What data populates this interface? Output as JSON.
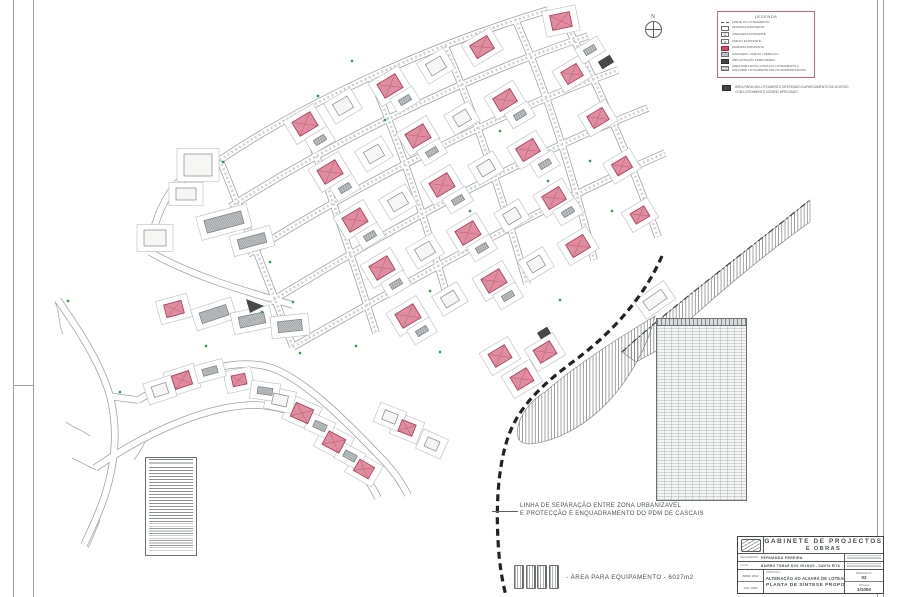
{
  "north": {
    "label": "N"
  },
  "legend": {
    "title": "LEGENDA",
    "items": [
      {
        "symbol": "limit-line",
        "label": "LIMITE DO LOTEAMENTO"
      },
      {
        "symbol": "existing-house",
        "label": "MORADIA EXISTENTE",
        "glyph": ""
      },
      {
        "symbol": "existing-garage",
        "label": "GARAGEM EXISTENTE",
        "glyph": "G"
      },
      {
        "symbol": "existing-annex",
        "label": "ANEXO EXISTENTE",
        "glyph": "A"
      },
      {
        "symbol": "proposed-house",
        "label": "MORADIA PROPOSTA"
      },
      {
        "symbol": "garage-annex-pergola",
        "label": "GARAGEM / ANEXO / PÉRGULA"
      },
      {
        "symbol": "temporary-implantation",
        "label": "IMPLANTAÇÃO TEMPORÁRIA"
      },
      {
        "symbol": "two-lots-area",
        "label": "ÁREA PARA DOIS LOTES DO LOTEAMENTO A ADQUIRIR TOTALMENTE PELOS PROPRIETÁRIOS"
      }
    ]
  },
  "legend_note": {
    "line1": "ÁREA PARA UM LOTEAMENTO DESTINADO A APARCAMENTO DE ACORDO",
    "line2": "COM LOTEAMENTO VIZINHO APROVADO"
  },
  "annotations": {
    "separation_line_1": "LINHA DE SEPARAÇÃO ENTRE ZONA URBANIZAVEL",
    "separation_line_2": "E PROTECÇÃO E ENQUADRAMENTO DO PDM DE CASCAIS",
    "equipment_area": "- ÁREA PARA EQUIPAMENTO  -  6027m2"
  },
  "title_block": {
    "office_line1": "GABINETE  DE  PROJECTOS",
    "office_line2": "E  OBRAS",
    "requerente_label": "REQUERENTE",
    "requerente": "FERNANDA PEREIRA",
    "local_label": "LOCAL",
    "local": "BAIRRO TOMAR DOS VELHOS - SANTA RITA",
    "proposta_label": "PROPOSTA",
    "proposta_line1": "ALTERAÇÃO AO ALVARÁ DE LOTEAMENTO 1/92",
    "proposta_line2": "PLANTA  DE  SÍNTESE  PROPOSTA",
    "date1": "ABRIL 2002",
    "date2": "JUN. 2002",
    "drawing_no_label": "DESENHO Nº",
    "drawing_no": "02",
    "scale_label": "ESCALA",
    "scale": "1/1000"
  },
  "map": {
    "colors": {
      "road_casing": "#999ea1",
      "road_fill": "#ffffff",
      "proposed_fill": "#df8ea1",
      "proposed_stroke": "#ad3350",
      "proposed_cross": "#c25a72",
      "existing_fill": "#f6f6f5",
      "existing_stroke": "#84898c",
      "garage_stroke": "#787d80",
      "dark_fill": "#45494c",
      "lot_stroke": "#b7bcbf",
      "tree": "#2f9e44",
      "hatch_line": "#777c7f",
      "boundary": "#3a3e41",
      "dashed": "#1f2326"
    },
    "roads": [
      "M220,160 C300,106 420,48 548,10",
      "M230,207 C320,150 450,82 588,36",
      "M248,254 C340,196 475,122 618,70",
      "M270,302 C372,240 505,164 648,108",
      "M293,347 C402,285 535,210 665,153",
      "M220,160 C238,205 260,258 293,347",
      "M300,113 C322,168 348,245 376,333",
      "M372,79 C396,136 424,212 450,307",
      "M445,46 C470,102 498,182 527,284",
      "M515,19 C541,77 567,152 594,260",
      "M560,13 C592,72 624,142 658,237",
      "M220,160 C205,167 190,174 176,184",
      "M176,184 C160,205 152,228 150,252",
      "M150,252 C190,275 240,290 293,305",
      "M138,400 C190,370 240,357 272,368 C305,380 345,420 385,462 C395,473 402,483 408,495",
      "M95,468 C150,430 210,405 255,405 C300,406 330,432 355,462 C365,475 372,486 378,498",
      "M58,300 C80,332 100,362 110,396 C118,428 116,462 104,498 C98,516 90,532 84,545",
      "M110,396 C120,398 130,399 138,400"
    ],
    "scribbles": [
      "M55,302 C60,312 58,324 63,334",
      "M66,422 C74,428 82,430 90,436",
      "M72,458 C80,462 88,466 96,470",
      "M150,430 C146,442 140,452 134,460",
      "M100,520 C96,530 92,540 88,548"
    ],
    "buildings": [
      [
        561,
        21,
        20,
        15,
        -12,
        "p"
      ],
      [
        305,
        124,
        21,
        16,
        -31,
        "p"
      ],
      [
        390,
        86,
        21,
        16,
        -31,
        "p"
      ],
      [
        482,
        47,
        20,
        15,
        -31,
        "p"
      ],
      [
        330,
        172,
        21,
        16,
        -31,
        "p"
      ],
      [
        418,
        136,
        21,
        16,
        -31,
        "p"
      ],
      [
        505,
        100,
        20,
        15,
        -31,
        "p"
      ],
      [
        572,
        74,
        18,
        14,
        -31,
        "p"
      ],
      [
        355,
        220,
        21,
        16,
        -31,
        "p"
      ],
      [
        442,
        185,
        21,
        16,
        -31,
        "p"
      ],
      [
        528,
        150,
        20,
        15,
        -31,
        "p"
      ],
      [
        598,
        118,
        18,
        14,
        -31,
        "p"
      ],
      [
        382,
        268,
        21,
        16,
        -31,
        "p"
      ],
      [
        468,
        233,
        21,
        16,
        -31,
        "p"
      ],
      [
        554,
        198,
        20,
        15,
        -31,
        "p"
      ],
      [
        622,
        166,
        17,
        13,
        -31,
        "p"
      ],
      [
        408,
        316,
        21,
        16,
        -31,
        "p"
      ],
      [
        494,
        281,
        21,
        16,
        -31,
        "p"
      ],
      [
        578,
        246,
        20,
        15,
        -31,
        "p"
      ],
      [
        640,
        215,
        16,
        12,
        -31,
        "p"
      ],
      [
        500,
        356,
        19,
        15,
        -31,
        "p"
      ],
      [
        545,
        352,
        19,
        15,
        -31,
        "p"
      ],
      [
        522,
        379,
        19,
        15,
        -31,
        "p"
      ],
      [
        174,
        309,
        18,
        13,
        -15,
        "p"
      ],
      [
        182,
        380,
        18,
        14,
        -18,
        "p"
      ],
      [
        239,
        380,
        14,
        11,
        -12,
        "p"
      ],
      [
        302,
        413,
        19,
        15,
        24,
        "p"
      ],
      [
        334,
        442,
        19,
        15,
        28,
        "p"
      ],
      [
        364,
        469,
        17,
        13,
        30,
        "p"
      ],
      [
        407,
        428,
        15,
        12,
        22,
        "p"
      ],
      [
        343,
        106,
        17,
        13,
        -31,
        "w"
      ],
      [
        436,
        66,
        17,
        13,
        -31,
        "w"
      ],
      [
        374,
        154,
        17,
        13,
        -31,
        "w"
      ],
      [
        462,
        118,
        15,
        12,
        -31,
        "w"
      ],
      [
        398,
        202,
        17,
        13,
        -31,
        "w"
      ],
      [
        486,
        168,
        15,
        12,
        -31,
        "w"
      ],
      [
        425,
        251,
        17,
        13,
        -31,
        "w"
      ],
      [
        512,
        216,
        15,
        12,
        -31,
        "w"
      ],
      [
        450,
        299,
        15,
        12,
        -31,
        "w"
      ],
      [
        536,
        264,
        15,
        12,
        -31,
        "w"
      ],
      [
        198,
        165,
        28,
        22,
        0,
        "w"
      ],
      [
        186,
        194,
        20,
        12,
        0,
        "w"
      ],
      [
        155,
        238,
        22,
        16,
        0,
        "w"
      ],
      [
        160,
        390,
        15,
        11,
        -18,
        "w"
      ],
      [
        280,
        400,
        15,
        11,
        12,
        "w"
      ],
      [
        390,
        417,
        14,
        10,
        22,
        "w"
      ],
      [
        432,
        444,
        13,
        10,
        24,
        "w"
      ],
      [
        655,
        300,
        22,
        11,
        -35,
        "w"
      ],
      [
        320,
        140,
        12,
        6,
        -31,
        "g"
      ],
      [
        405,
        100,
        12,
        6,
        -31,
        "g"
      ],
      [
        345,
        188,
        12,
        6,
        -31,
        "g"
      ],
      [
        432,
        152,
        12,
        6,
        -31,
        "g"
      ],
      [
        520,
        115,
        12,
        6,
        -31,
        "g"
      ],
      [
        370,
        236,
        12,
        6,
        -31,
        "g"
      ],
      [
        458,
        200,
        12,
        6,
        -31,
        "g"
      ],
      [
        545,
        164,
        12,
        6,
        -31,
        "g"
      ],
      [
        396,
        284,
        12,
        6,
        -31,
        "g"
      ],
      [
        482,
        248,
        12,
        6,
        -31,
        "g"
      ],
      [
        568,
        212,
        12,
        6,
        -31,
        "g"
      ],
      [
        422,
        331,
        12,
        6,
        -31,
        "g"
      ],
      [
        508,
        296,
        12,
        6,
        -31,
        "g"
      ],
      [
        590,
        50,
        12,
        6,
        -31,
        "g"
      ],
      [
        224,
        222,
        38,
        13,
        -15,
        "g"
      ],
      [
        252,
        241,
        28,
        10,
        -15,
        "g"
      ],
      [
        214,
        314,
        28,
        11,
        -18,
        "g"
      ],
      [
        252,
        320,
        26,
        11,
        -12,
        "g"
      ],
      [
        290,
        326,
        24,
        11,
        -6,
        "g"
      ],
      [
        210,
        371,
        15,
        7,
        -15,
        "g"
      ],
      [
        265,
        391,
        15,
        7,
        8,
        "g"
      ],
      [
        320,
        426,
        13,
        7,
        24,
        "g"
      ],
      [
        350,
        456,
        13,
        7,
        28,
        "g"
      ],
      [
        606,
        62,
        13,
        8,
        -31,
        "d"
      ],
      [
        544,
        333,
        11,
        7,
        -31,
        "d"
      ]
    ],
    "dark_triangle": "M246,299 L264,306 L250,313 Z",
    "trees": [
      [
        223,
        162
      ],
      [
        270,
        262
      ],
      [
        293,
        302
      ],
      [
        318,
        96
      ],
      [
        352,
        61
      ],
      [
        500,
        131
      ],
      [
        548,
        181
      ],
      [
        470,
        211
      ],
      [
        430,
        291
      ],
      [
        590,
        161
      ],
      [
        612,
        211
      ],
      [
        356,
        346
      ],
      [
        300,
        353
      ],
      [
        262,
        312
      ],
      [
        206,
        346
      ],
      [
        68,
        301
      ],
      [
        120,
        392
      ],
      [
        440,
        352
      ],
      [
        560,
        300
      ],
      [
        385,
        120
      ]
    ],
    "hatch_zones": [
      "M622,352 C665,312 745,252 810,200 L810,222 C762,256 700,308 658,350 L636,362 Z",
      "M545,392 C572,368 615,340 655,316 C648,345 630,380 605,405 C580,430 552,442 530,444 C518,444 514,436 520,420 C526,406 535,398 545,392 Z"
    ],
    "boundary_dashdot": "M622,352 C665,312 745,252 810,200",
    "dashed_line": "M662,256 C645,295 615,330 578,358 C548,380 522,402 510,432 C498,462 496,505 498,540 C499,562 502,580 506,596"
  }
}
